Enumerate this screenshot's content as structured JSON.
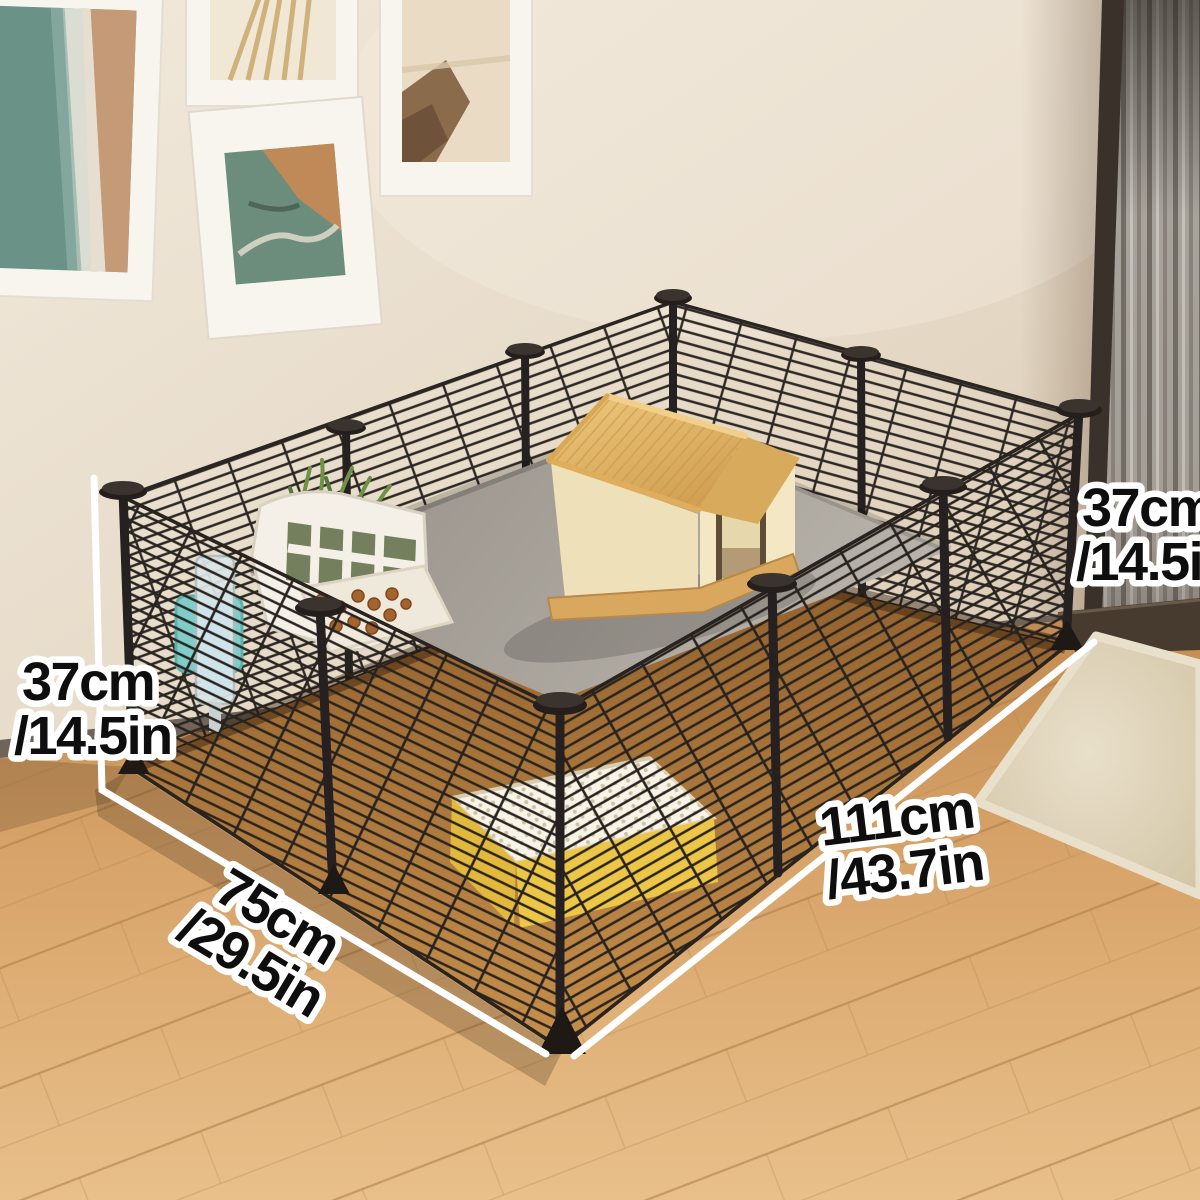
{
  "dimensions": {
    "left_height": {
      "line1": "37cm",
      "line2": "/14.5in"
    },
    "right_height": {
      "line1": "37cm",
      "line2": "/14.5in"
    },
    "front_width": {
      "line1": "75cm",
      "line2": "/29.5in"
    },
    "side_length": {
      "line1": "111cm",
      "line2": "/43.7in"
    }
  },
  "colors": {
    "dimension_line": "#ffffff",
    "label_text": "#0e0e0e",
    "label_outline": "#ffffff",
    "cage_wire": "#2b2522",
    "mat_gray": "#a9a29a",
    "house_roof": "#e0b167",
    "house_wall": "#f2e6c2",
    "litter_box_yellow": "#eac43f",
    "rug_beige": "#d9cdb2",
    "floor_wood": "#d8a569",
    "wall_cream": "#e7dccb",
    "door_frame": "#3a312a"
  }
}
